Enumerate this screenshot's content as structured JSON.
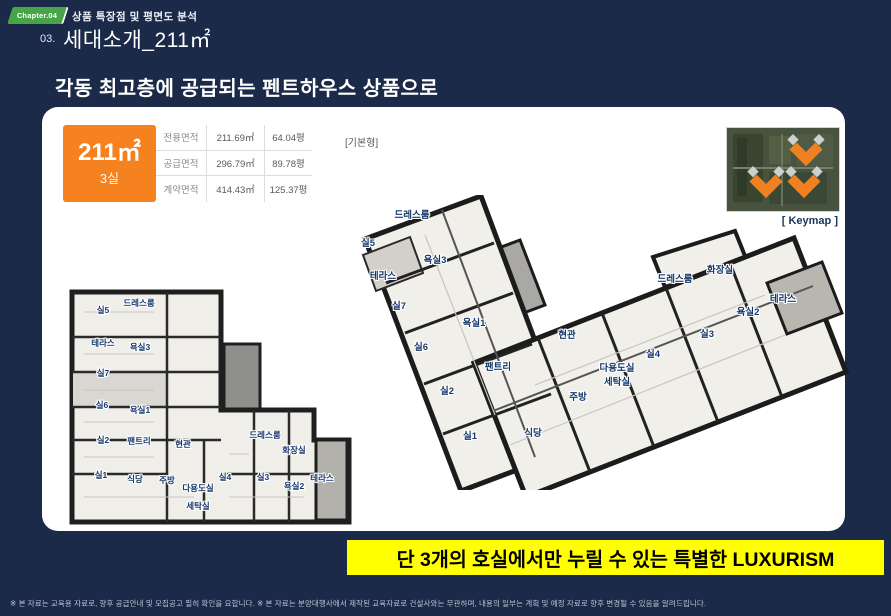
{
  "colors": {
    "background": "#1c2a49",
    "accent_orange": "#f5821f",
    "badge_green": "#47a447",
    "banner_yellow": "#ffff00",
    "keymap_caption_blue": "#17365d",
    "room_label_navy": "#17386b"
  },
  "header": {
    "chapter_badge": "Chapter.04",
    "breadcrumb": "상품 특장점 및 평면도 분석",
    "section_number": "03.",
    "title": "세대소개_211㎡"
  },
  "subtitle": "각동 최고층에 공급되는 펜트하우스 상품으로",
  "unit_card": {
    "area": "211㎡",
    "rooms": "3실"
  },
  "area_table": {
    "rows": [
      {
        "label": "전용면적",
        "sqm": "211.69㎡",
        "pyeong": "64.04평"
      },
      {
        "label": "공급면적",
        "sqm": "296.79㎡",
        "pyeong": "89.78평"
      },
      {
        "label": "계약면적",
        "sqm": "414.43㎡",
        "pyeong": "125.37평"
      }
    ]
  },
  "captions": {
    "base_plan": "[기본형]",
    "floor_plan": "[평면도]",
    "keymap": "[ Keymap ]"
  },
  "plans": {
    "left": {
      "labels": [
        {
          "text": "실5",
          "x": 39,
          "y": 28
        },
        {
          "text": "드레스룸",
          "x": 75,
          "y": 21
        },
        {
          "text": "테라스",
          "x": 39,
          "y": 61
        },
        {
          "text": "욕실3",
          "x": 76,
          "y": 65
        },
        {
          "text": "실7",
          "x": 39,
          "y": 91
        },
        {
          "text": "실6",
          "x": 38,
          "y": 123
        },
        {
          "text": "욕실1",
          "x": 76,
          "y": 128
        },
        {
          "text": "실2",
          "x": 39,
          "y": 158
        },
        {
          "text": "팬트리",
          "x": 75,
          "y": 159
        },
        {
          "text": "현관",
          "x": 119,
          "y": 162
        },
        {
          "text": "실1",
          "x": 37,
          "y": 193
        },
        {
          "text": "식당",
          "x": 71,
          "y": 197
        },
        {
          "text": "주방",
          "x": 103,
          "y": 198
        },
        {
          "text": "다용도실",
          "x": 134,
          "y": 206
        },
        {
          "text": "세탁실",
          "x": 134,
          "y": 224
        },
        {
          "text": "실4",
          "x": 161,
          "y": 195
        },
        {
          "text": "드레스룸",
          "x": 201,
          "y": 153
        },
        {
          "text": "화장실",
          "x": 230,
          "y": 168
        },
        {
          "text": "실3",
          "x": 199,
          "y": 195
        },
        {
          "text": "욕실2",
          "x": 230,
          "y": 204
        },
        {
          "text": "테라스",
          "x": 258,
          "y": 196
        }
      ]
    },
    "right": {
      "labels": [
        {
          "text": "드레스룸",
          "x": 77,
          "y": 19
        },
        {
          "text": "실5",
          "x": 33,
          "y": 47
        },
        {
          "text": "욕실3",
          "x": 100,
          "y": 64
        },
        {
          "text": "테라스",
          "x": 48,
          "y": 80
        },
        {
          "text": "실7",
          "x": 64,
          "y": 110
        },
        {
          "text": "욕실1",
          "x": 139,
          "y": 127
        },
        {
          "text": "실6",
          "x": 86,
          "y": 151
        },
        {
          "text": "현관",
          "x": 232,
          "y": 139
        },
        {
          "text": "팬트리",
          "x": 163,
          "y": 171
        },
        {
          "text": "실2",
          "x": 112,
          "y": 195
        },
        {
          "text": "다용도실",
          "x": 282,
          "y": 172
        },
        {
          "text": "세탁실",
          "x": 282,
          "y": 186
        },
        {
          "text": "주방",
          "x": 243,
          "y": 201
        },
        {
          "text": "실1",
          "x": 135,
          "y": 240
        },
        {
          "text": "식당",
          "x": 198,
          "y": 237
        },
        {
          "text": "드레스룸",
          "x": 340,
          "y": 83
        },
        {
          "text": "화장실",
          "x": 385,
          "y": 74
        },
        {
          "text": "테라스",
          "x": 448,
          "y": 103
        },
        {
          "text": "욕실2",
          "x": 413,
          "y": 116
        },
        {
          "text": "실3",
          "x": 372,
          "y": 138
        },
        {
          "text": "실4",
          "x": 318,
          "y": 158
        }
      ]
    }
  },
  "banner": "단 3개의 호실에서만 누릴 수 있는 특별한 LUXURISM",
  "footer": {
    "note": "※ 본 자료는 교육용 자료로, 향후 공급안내 및 모집공고 필히 확인을 요합니다. ※ 본 자료는 분양대행사에서 제작된 교육자료로 건설사와는 무관하며, 내용의 일부는 계획 및 예정 자료로 향후 변경될 수 있음을 알려드립니다."
  }
}
